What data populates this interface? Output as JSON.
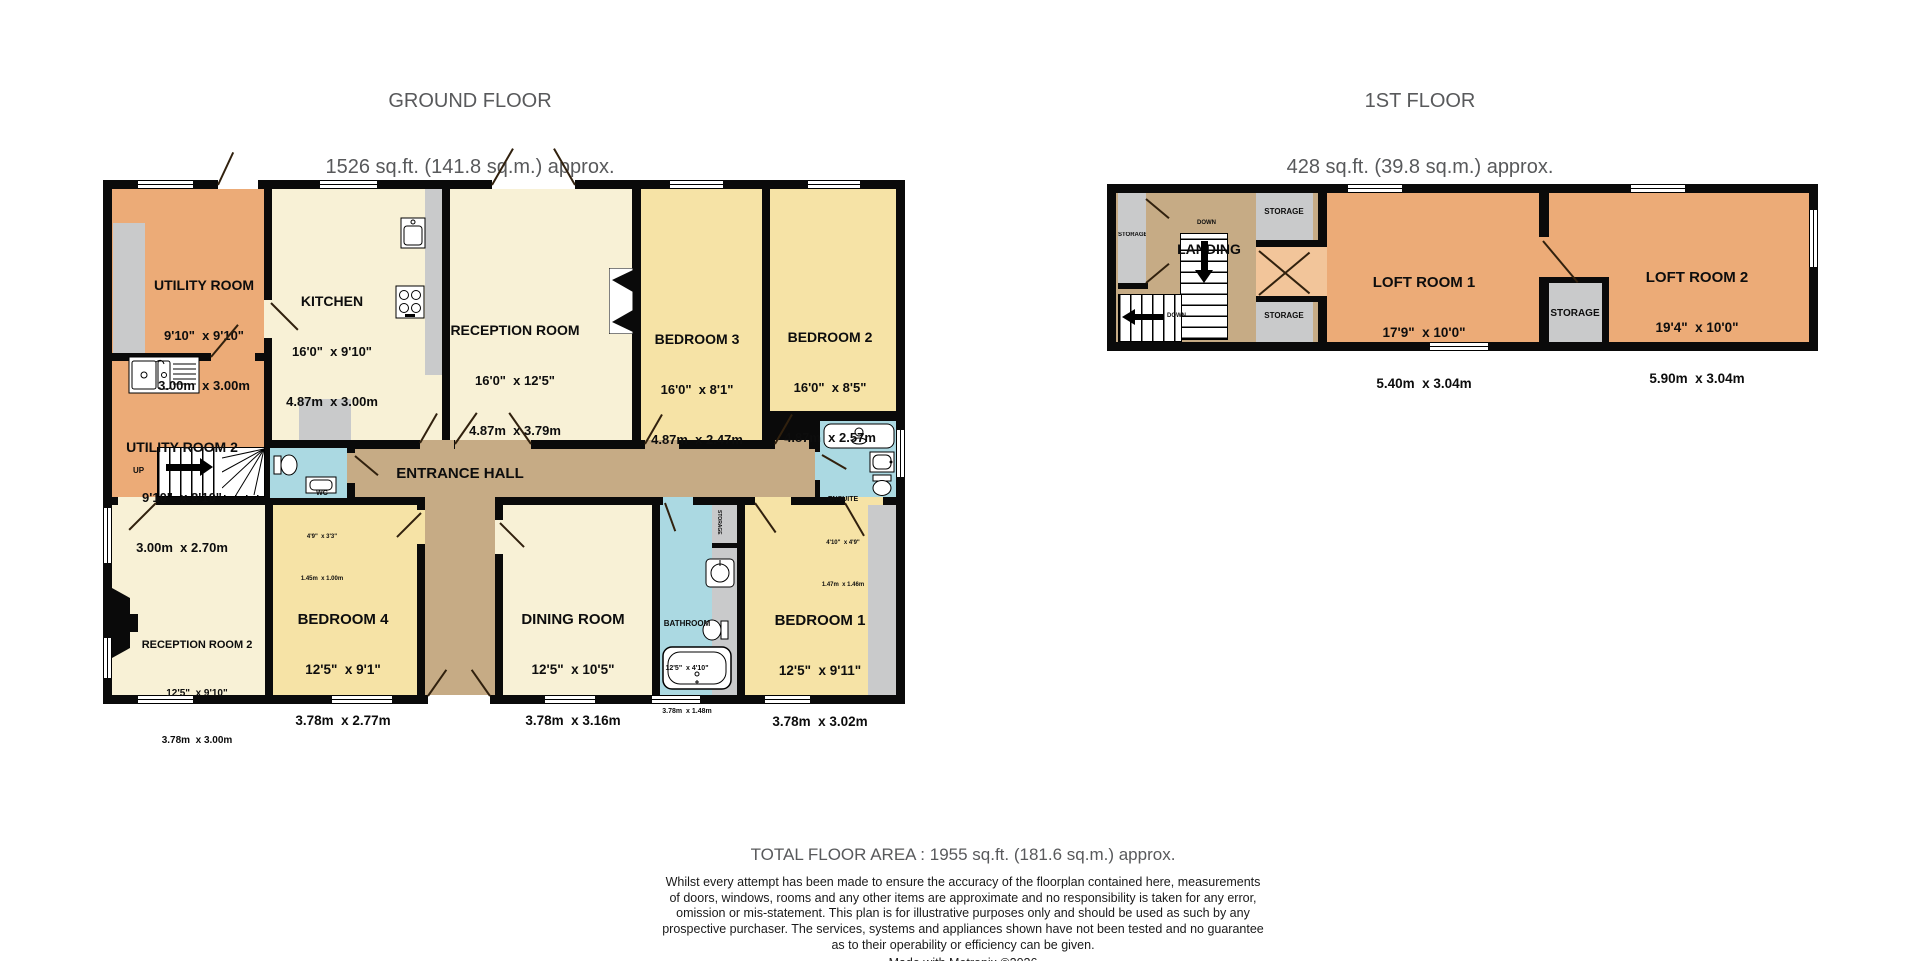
{
  "colors": {
    "wall": "#0a0a0a",
    "room_orange": "#ecab77",
    "room_orange_light": "#f2c59a",
    "room_cream": "#f8f1d6",
    "room_yellow": "#f6e3a6",
    "room_blue": "#abd9e2",
    "hall_tan": "#c6ab85",
    "storage_gray": "#c9cacb",
    "title_text": "#58595b",
    "label_text": "#0d0d0d"
  },
  "ground_floor": {
    "title": "GROUND FLOOR",
    "subtitle": "1526 sq.ft. (141.8 sq.m.) approx.",
    "rooms": {
      "utility1": {
        "name": "UTILITY ROOM",
        "imperial": "9'10\"  x 9'10\"",
        "metric": "3.00m  x 3.00m"
      },
      "kitchen": {
        "name": "KITCHEN",
        "imperial": "16'0\"  x 9'10\"",
        "metric": "4.87m  x 3.00m"
      },
      "reception1": {
        "name": "RECEPTION ROOM",
        "imperial": "16'0\"  x 12'5\"",
        "metric": "4.87m  x 3.79m"
      },
      "bedroom3": {
        "name": "BEDROOM 3",
        "imperial": "16'0\"  x 8'1\"",
        "metric": "4.87m  x 2.47m"
      },
      "bedroom2": {
        "name": "BEDROOM 2",
        "imperial": "16'0\"  x 8'5\"",
        "metric": "4.87m  x 2.57m"
      },
      "utility2": {
        "name": "UTILITY ROOM 2",
        "imperial": "9'10\"  x 8'10\"",
        "metric": "3.00m  x 2.70m"
      },
      "wc": {
        "name": "WC",
        "imperial": "4'9\"  x 3'3\"",
        "metric": "1.45m  x 1.00m"
      },
      "entrance_hall": {
        "name": "ENTRANCE HALL"
      },
      "ensuite": {
        "name": "ENSUITE",
        "imperial": "4'10\"  x 4'9\"",
        "metric": "1.47m  x 1.46m"
      },
      "reception2": {
        "name": "RECEPTION ROOM 2",
        "imperial": "12'5\"  x 9'10\"",
        "metric": "3.78m  x 3.00m"
      },
      "bedroom4": {
        "name": "BEDROOM 4",
        "imperial": "12'5\"  x 9'1\"",
        "metric": "3.78m  x 2.77m"
      },
      "dining": {
        "name": "DINING ROOM",
        "imperial": "12'5\"  x 10'5\"",
        "metric": "3.78m  x 3.16m"
      },
      "bathroom": {
        "name": "BATHROOM",
        "imperial": "12'5\"  x 4'10\"",
        "metric": "3.78m  x 1.48m"
      },
      "bedroom1": {
        "name": "BEDROOM 1",
        "imperial": "12'5\"  x 9'11\"",
        "metric": "3.78m  x 3.02m"
      },
      "storage": {
        "name": "STORAGE"
      }
    },
    "stairs": {
      "up_label": "UP"
    }
  },
  "first_floor": {
    "title": "1ST FLOOR",
    "subtitle": "428 sq.ft. (39.8 sq.m.) approx.",
    "rooms": {
      "landing": {
        "name": "LANDING"
      },
      "loft1": {
        "name": "LOFT ROOM 1",
        "imperial": "17'9\"  x 10'0\"",
        "metric": "5.40m  x 3.04m"
      },
      "loft2": {
        "name": "LOFT ROOM 2",
        "imperial": "19'4\"  x 10'0\"",
        "metric": "5.90m  x 3.04m"
      },
      "storage_left": {
        "name": "STORAGE"
      },
      "storage_top": {
        "name": "STORAGE"
      },
      "storage_bottom": {
        "name": "STORAGE"
      },
      "storage_mid": {
        "name": "STORAGE"
      }
    },
    "stairs": {
      "down_label_1": "DOWN",
      "down_label_2": "DOWN"
    }
  },
  "footer": {
    "total": "TOTAL FLOOR AREA : 1955 sq.ft. (181.6 sq.m.) approx.",
    "disclaimer": [
      "Whilst every attempt has been made to ensure the accuracy of the floorplan contained here, measurements",
      "of doors, windows, rooms and any other items are approximate and no responsibility is taken for any error,",
      "omission or mis-statement. This plan is for illustrative purposes only and should be used as such by any",
      "prospective purchaser. The services, systems and appliances shown have not been tested and no guarantee",
      "as to their operability or efficiency can be given."
    ],
    "credit": "Made with Metropix ©2026"
  },
  "icons": [
    "sink-icon",
    "drainer-sink-icon",
    "hob-icon",
    "toilet-icon",
    "basin-icon",
    "bath-icon",
    "shower-icon",
    "fireplace-icon",
    "chimney-icon",
    "stairs-up-icon",
    "stairs-down-icon",
    "window",
    "door-leaf"
  ]
}
